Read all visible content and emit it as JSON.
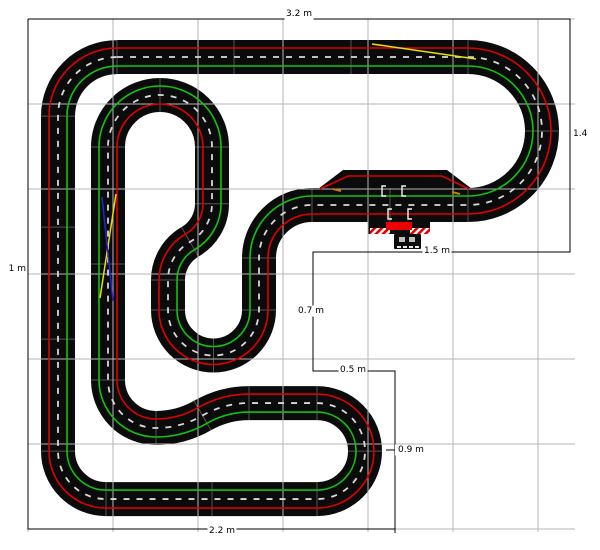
{
  "canvas": {
    "width": 600,
    "height": 550,
    "background": "#ffffff"
  },
  "grid": {
    "color": "#b5b5b5",
    "x_lines": [
      28,
      113,
      198,
      283,
      368,
      453,
      538
    ],
    "y_lines": [
      19,
      104,
      189,
      274,
      359,
      444,
      529
    ],
    "x_extent": [
      28,
      575
    ],
    "y_extent": [
      19,
      532
    ]
  },
  "colors": {
    "track": "#0b0b0b",
    "lane_left_red": "#e00000",
    "lane_right_green": "#12c212",
    "center_dash": "#d9d9d9",
    "joint": "#8f8f8f",
    "dimension": "#000000",
    "lane_change_yellow": "#e8e000",
    "lane_change_blue": "#2424dd",
    "marker_orange": "#c97a00",
    "start_bar_red": "#ee0000",
    "pad_gray": "#bfbfbf",
    "bracket_white": "#f2f2f2"
  },
  "dimension_outline": {
    "points": [
      [
        28,
        19
      ],
      [
        570,
        19
      ],
      [
        570,
        252
      ],
      [
        313,
        252
      ],
      [
        313,
        371
      ],
      [
        395,
        371
      ],
      [
        395,
        529
      ],
      [
        28,
        529
      ],
      [
        28,
        19
      ]
    ],
    "ticks": [
      [
        395,
        529,
        395,
        533
      ]
    ]
  },
  "dimension_labels": [
    {
      "text": "3.2 m",
      "x": 299,
      "y": 14,
      "anchor": "middle",
      "bg": true
    },
    {
      "text": "1.4",
      "x": 573,
      "y": 134,
      "anchor": "start",
      "bg": false
    },
    {
      "text": "1.5 m",
      "x": 437,
      "y": 251,
      "anchor": "middle",
      "bg": true
    },
    {
      "text": "0.7 m",
      "x": 311,
      "y": 311,
      "anchor": "middle",
      "bg": true
    },
    {
      "text": "0.5 m",
      "x": 353,
      "y": 370,
      "anchor": "middle",
      "bg": true
    },
    {
      "text": "0.9 m",
      "x": 398,
      "y": 450,
      "anchor": "start",
      "bg": true,
      "leader": [
        386,
        450,
        395,
        450
      ]
    },
    {
      "text": "2.2 m",
      "x": 222,
      "y": 531,
      "anchor": "middle",
      "bg": true
    },
    {
      "text": "1 m",
      "x": 26,
      "y": 269,
      "anchor": "end",
      "bg": true
    }
  ],
  "track": {
    "start": {
      "x": 117,
      "y": 57,
      "heading": 0
    },
    "half_width": 17,
    "lane_offset": 9,
    "pieces": [
      {
        "type": "straight",
        "len": 117
      },
      {
        "type": "straight",
        "len": 117
      },
      {
        "type": "straight",
        "len": 117
      },
      {
        "type": "arc",
        "r": 74,
        "deg": 90,
        "dir": "R"
      },
      {
        "type": "arc",
        "r": 74,
        "deg": 90,
        "dir": "R"
      },
      {
        "type": "straight",
        "len": 78
      },
      {
        "type": "straight",
        "len": 78
      },
      {
        "type": "arc",
        "r": 53,
        "deg": 90,
        "dir": "L"
      },
      {
        "type": "straight",
        "len": 52
      },
      {
        "type": "arc",
        "r": 45.5,
        "deg": 90,
        "dir": "R"
      },
      {
        "type": "arc",
        "r": 45.5,
        "deg": 90,
        "dir": "R"
      },
      {
        "type": "straight",
        "len": 30
      },
      {
        "type": "arc",
        "r": 44,
        "deg": 60,
        "dir": "R"
      },
      {
        "type": "arc",
        "r": 44,
        "deg": 60,
        "dir": "L"
      },
      {
        "type": "straight",
        "len": 56.8
      },
      {
        "type": "arc",
        "r": 52,
        "deg": 90,
        "dir": "L"
      },
      {
        "type": "arc",
        "r": 52,
        "deg": 90,
        "dir": "L"
      },
      {
        "type": "straight",
        "len": 117
      },
      {
        "type": "straight",
        "len": 116
      },
      {
        "type": "arc",
        "r": 48,
        "deg": 90,
        "dir": "L"
      },
      {
        "type": "arc",
        "r": 93,
        "deg": 30,
        "dir": "L"
      },
      {
        "type": "arc",
        "r": 93,
        "deg": 30,
        "dir": "R"
      },
      {
        "type": "straight",
        "len": 68
      },
      {
        "type": "arc",
        "r": 48,
        "deg": 90,
        "dir": "R"
      },
      {
        "type": "arc",
        "r": 48,
        "deg": 90,
        "dir": "R"
      },
      {
        "type": "straight",
        "len": 105
      },
      {
        "type": "straight",
        "len": 106
      },
      {
        "type": "arc",
        "r": 48,
        "deg": 90,
        "dir": "R"
      },
      {
        "type": "straight",
        "len": 112
      },
      {
        "type": "straight",
        "len": 112
      },
      {
        "type": "straight",
        "len": 111
      },
      {
        "type": "arc",
        "r": 59,
        "deg": 90,
        "dir": "R"
      }
    ]
  },
  "pit": {
    "polygon": [
      [
        318,
        189
      ],
      [
        343,
        170
      ],
      [
        447,
        170
      ],
      [
        472,
        189
      ]
    ],
    "red_line": [
      [
        320,
        189
      ],
      [
        348,
        176
      ],
      [
        442,
        176
      ],
      [
        469,
        189
      ]
    ]
  },
  "start_finish": {
    "tab": {
      "x": 368,
      "y": 221,
      "w": 62,
      "h": 13
    },
    "stripe_left": {
      "x": 370,
      "y": 228,
      "w": 20,
      "h": 6
    },
    "stripe_right": {
      "x": 410,
      "y": 228,
      "w": 20,
      "h": 6
    },
    "red_bar": {
      "x": 386,
      "y": 222,
      "w": 26,
      "h": 8
    },
    "controller": {
      "x": 394,
      "y": 234,
      "w": 27,
      "h": 15
    },
    "pads": [
      {
        "x": 399,
        "y": 237,
        "w": 6,
        "h": 5
      },
      {
        "x": 409,
        "y": 237,
        "w": 6,
        "h": 5
      }
    ],
    "dashes": [
      {
        "x": 397,
        "y": 246,
        "w": 4,
        "h": 2
      },
      {
        "x": 403,
        "y": 246,
        "w": 4,
        "h": 2
      },
      {
        "x": 409,
        "y": 246,
        "w": 4,
        "h": 2
      },
      {
        "x": 415,
        "y": 246,
        "w": 4,
        "h": 2
      }
    ],
    "grid_brackets": [
      {
        "x": 382,
        "y": 186
      },
      {
        "x": 402,
        "y": 186
      },
      {
        "x": 388,
        "y": 209
      },
      {
        "x": 408,
        "y": 209
      }
    ]
  },
  "overlays": {
    "lane_change_top_yellow": [
      [
        372,
        44
      ],
      [
        476,
        59
      ]
    ],
    "cross_yellow": [
      [
        116,
        194
      ],
      [
        100,
        298
      ]
    ],
    "cross_blue": [
      [
        102,
        197
      ],
      [
        113,
        301
      ]
    ],
    "orange_ticks": [
      [
        333,
        189,
        341,
        191
      ],
      [
        452,
        192,
        460,
        194
      ]
    ]
  }
}
